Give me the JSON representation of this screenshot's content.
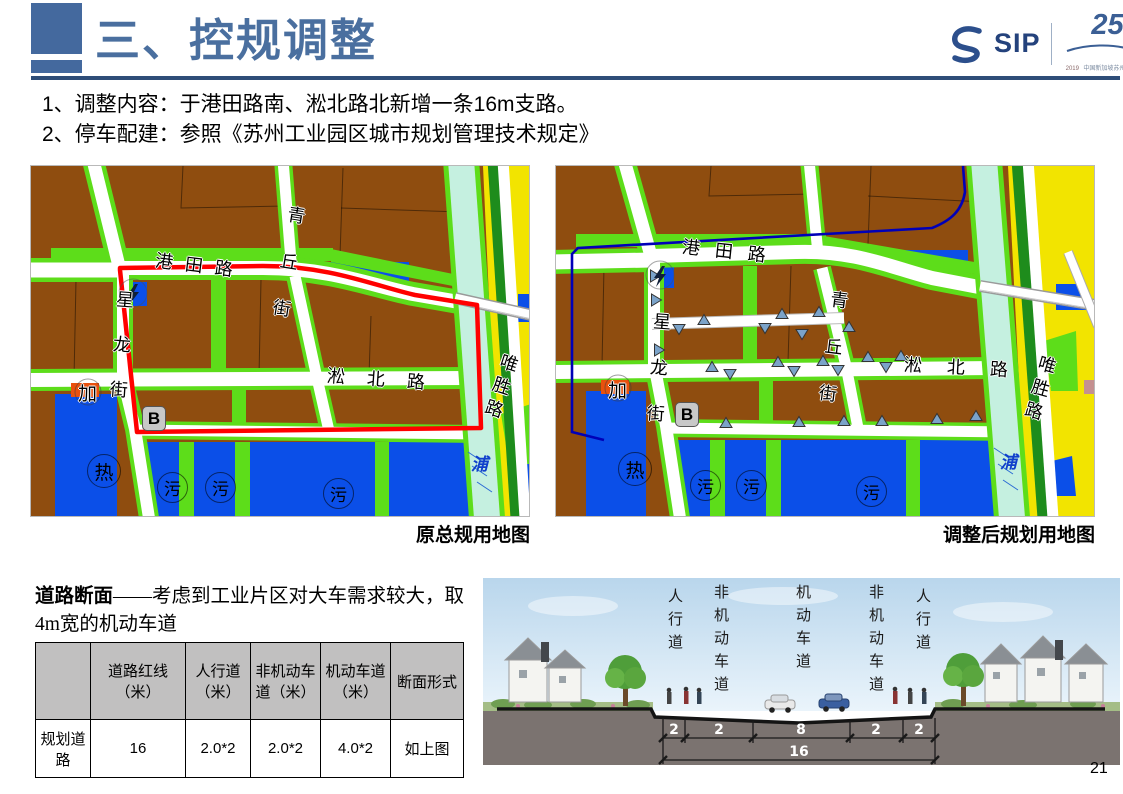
{
  "header": {
    "title": "三、控规调整",
    "logo": {
      "sip": "SIP",
      "anniversary_number": "25",
      "anniversary_years": "1994-2019",
      "anniversary_org": "中国新加坡苏州工业园区"
    }
  },
  "bullets": {
    "item1": "1、调整内容：于港田路南、淞北路北新增一条16m支路。",
    "item2": "2、停车配建：参照《苏州工业园区城市规划管理技术规定》"
  },
  "maps": {
    "left_caption": "原总规用地图",
    "right_caption": "调整后规划用地图",
    "road_labels": {
      "gangtian": "港田路",
      "qingqiu": "青丘街",
      "xinglong": "星龙街",
      "songbei": "淞北路",
      "weisheng": "唯胜路"
    },
    "poi_labels": {
      "gas": "加",
      "block_b": "B",
      "heat": "热",
      "sewage": "污",
      "river": "浦"
    },
    "colors": {
      "industrial_brown": "#8f4d0f",
      "green_belt": "#5ddd1a",
      "dark_green": "#1e8c1c",
      "utility_blue": "#0b4fe8",
      "river_cyan": "#c5f0e0",
      "residential_yellow": "#f2e400",
      "boundary_red": "#ff0000",
      "boundary_blue": "#0000b8"
    }
  },
  "road_section": {
    "heading_bold": "道路断面",
    "heading_rest": "——考虑到工业片区对大车需求较大，取4m宽的机动车道",
    "table": {
      "headers": [
        "",
        "道路红线（米）",
        "人行道（米）",
        "非机动车道（米）",
        "机动车道（米）",
        "断面形式"
      ],
      "row": [
        "规划道路",
        "16",
        "2.0*2",
        "2.0*2",
        "4.0*2",
        "如上图"
      ]
    },
    "diagram": {
      "lane_labels": [
        "人行道",
        "非机动车道",
        "机动车道",
        "非机动车道",
        "人行道"
      ],
      "widths": [
        "2",
        "2",
        "8",
        "2",
        "2"
      ],
      "total_width": "16"
    }
  },
  "page_number": "21"
}
